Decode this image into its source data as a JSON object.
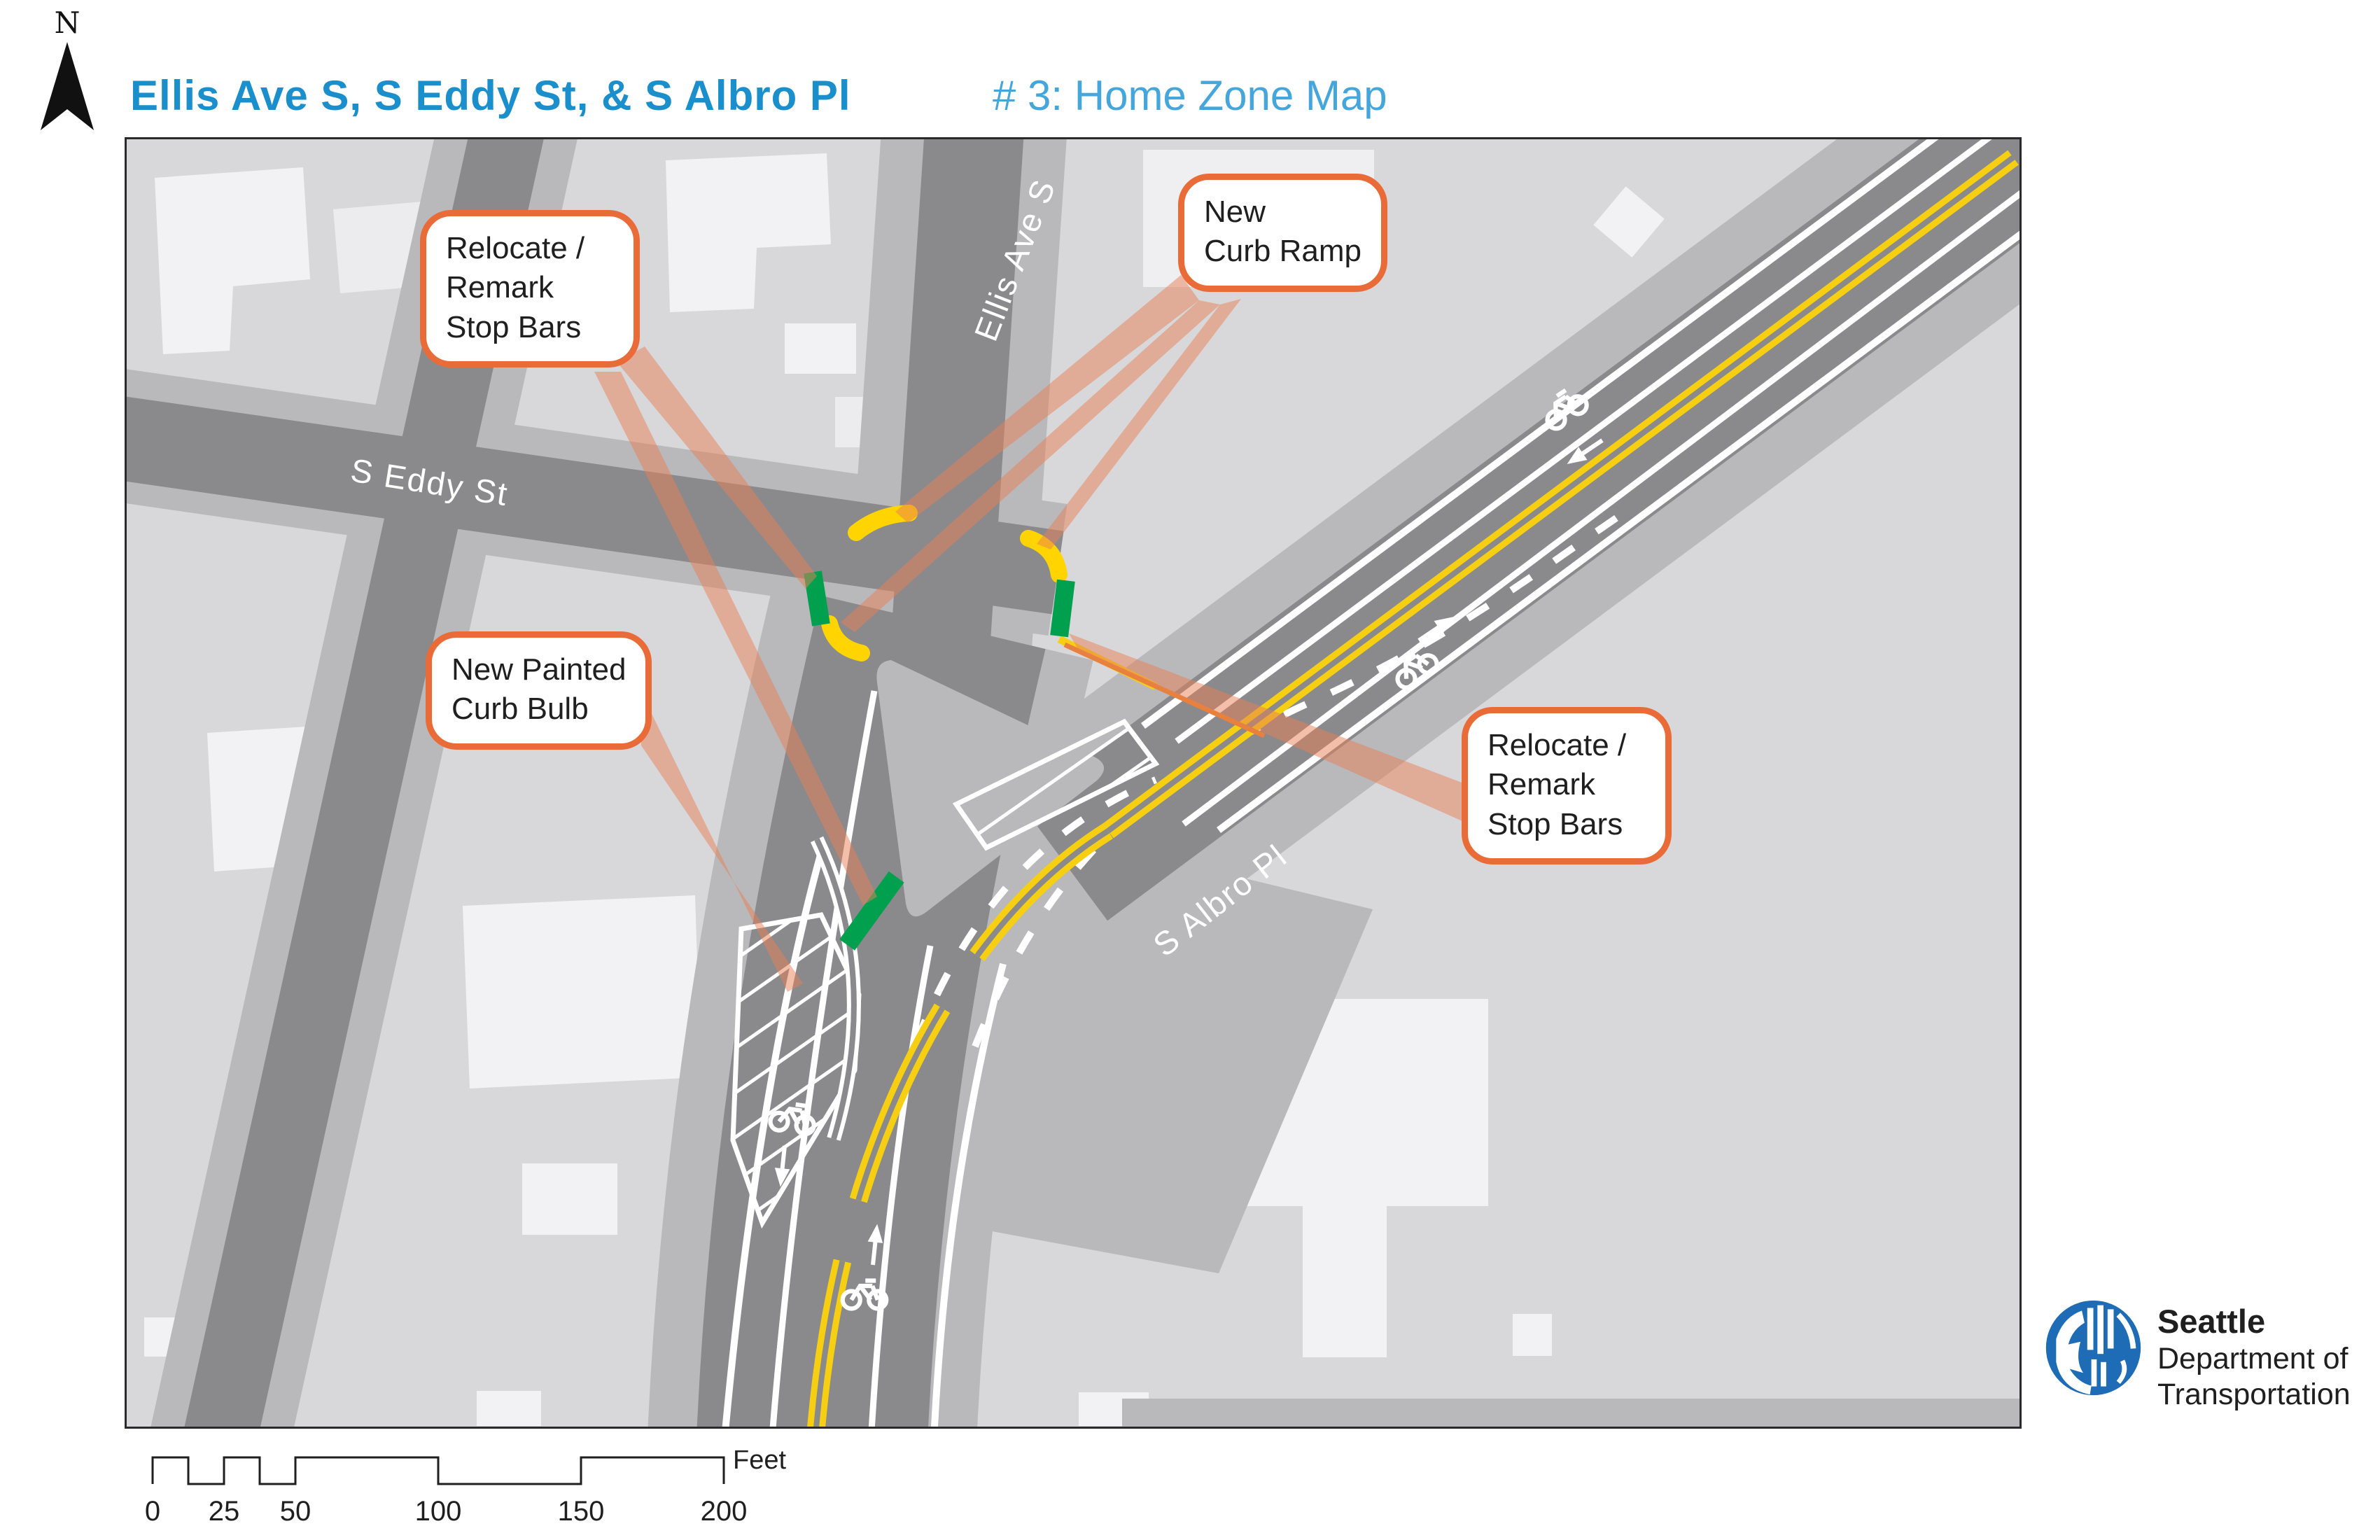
{
  "header": {
    "title": "Ellis Ave S, S Eddy St, & S Albro Pl",
    "subtitle": "# 3: Home Zone Map"
  },
  "compass": {
    "label": "N"
  },
  "map": {
    "street_labels": [
      {
        "name": "S Eddy St"
      },
      {
        "name": "Ellis Ave S"
      },
      {
        "name": "S Albro Pl"
      }
    ],
    "callouts": [
      {
        "id": "relocate-remark-stop-bars-west",
        "line1": "Relocate /",
        "line2": "Remark",
        "line3": "Stop Bars"
      },
      {
        "id": "new-curb-ramp",
        "line1": "New",
        "line2": "Curb Ramp",
        "line3": ""
      },
      {
        "id": "new-painted-curb-bulb",
        "line1": "New Painted",
        "line2": "Curb Bulb",
        "line3": ""
      },
      {
        "id": "relocate-remark-stop-bars-east",
        "line1": "Relocate /",
        "line2": "Remark",
        "line3": "Stop Bars"
      }
    ]
  },
  "scale_bar": {
    "ticks": [
      "0",
      "25",
      "50",
      "100",
      "150",
      "200"
    ],
    "unit": "Feet"
  },
  "logo": {
    "line1": "Seattle",
    "line2": "Department of",
    "line3": "Transportation"
  },
  "colors": {
    "title_blue": "#1b8fcc",
    "subtitle_blue": "#45a6db",
    "callout_orange": "#e96c38",
    "leader_orange": "#e78055",
    "asphalt_gray": "#8a8a8c",
    "sidewalk_gray": "#b9b9bb",
    "block_gray": "#d8d8da",
    "building_white": "#f2f2f4",
    "stop_bar_green": "#00a04f",
    "curb_ramp_yellow": "#ffd400",
    "centerline_yellow": "#f7cf12",
    "logo_blue": "#1d6cb5"
  }
}
